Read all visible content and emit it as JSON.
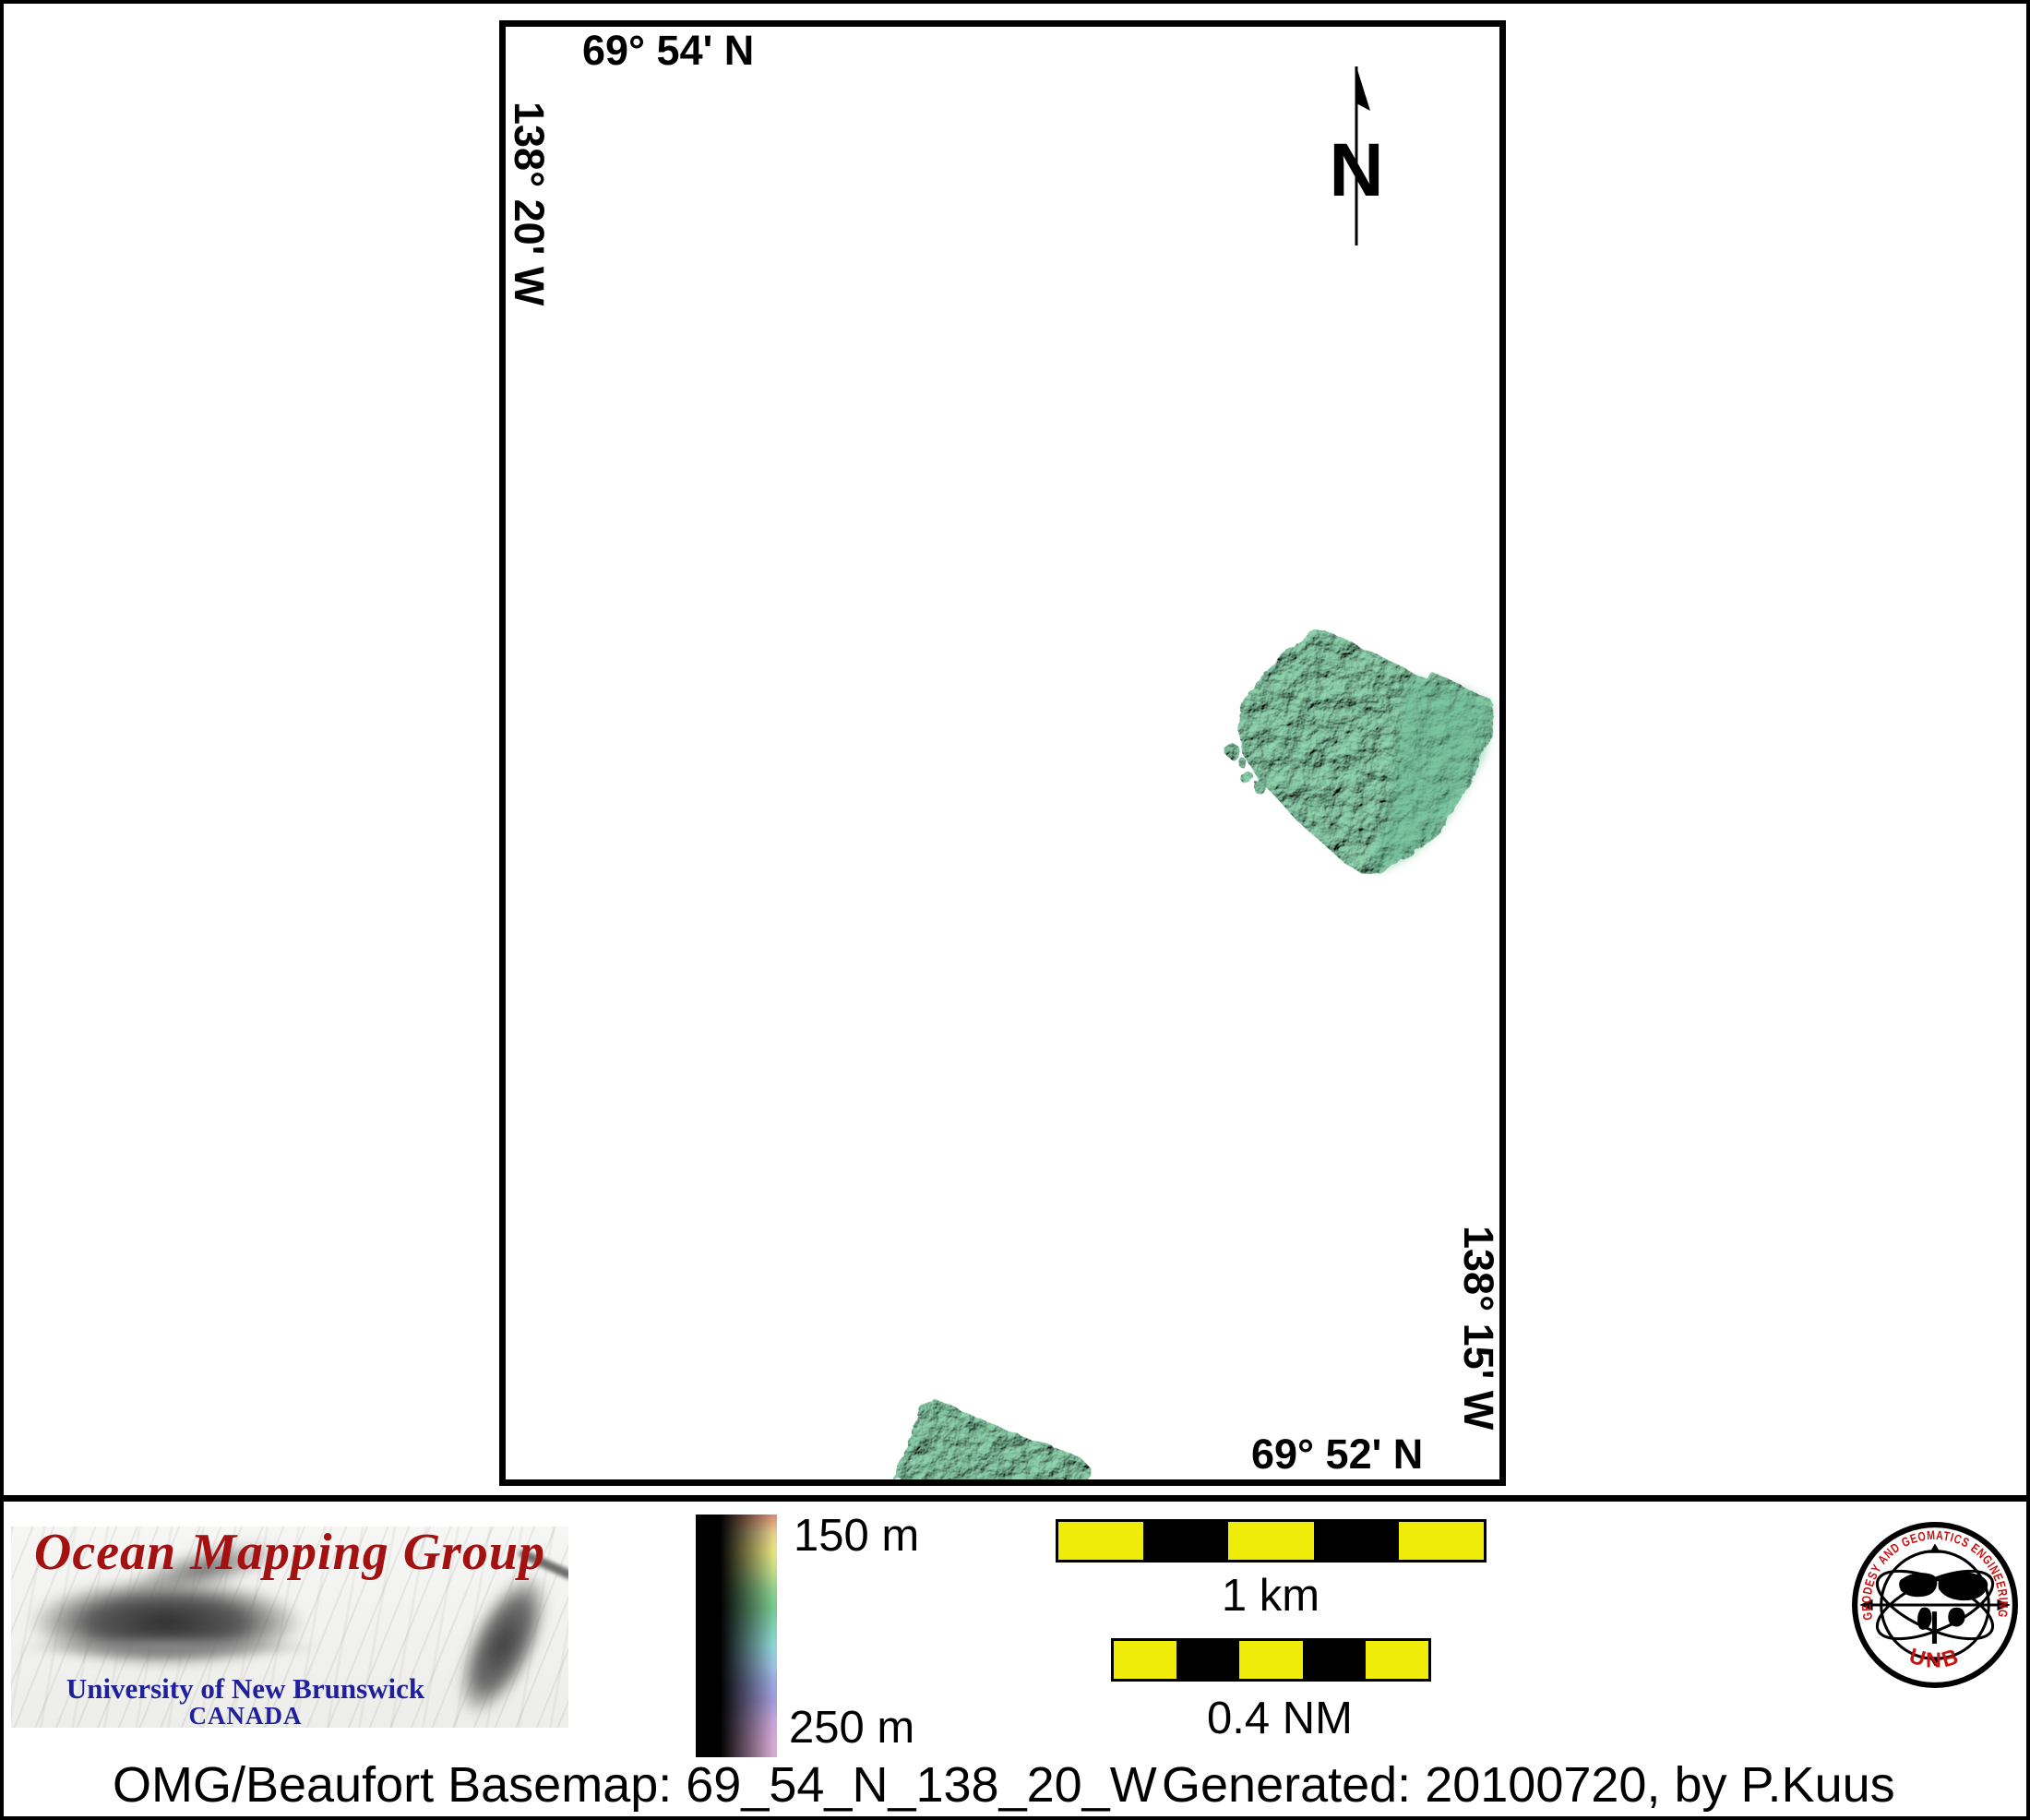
{
  "map": {
    "top_lat_label": "69° 54' N",
    "left_lon_label": "138° 20' W",
    "right_lon_label": "138° 15' W",
    "bottom_lat_label": "69° 52' N",
    "north_arrow_letter": "N"
  },
  "footer": {
    "omg_banner": {
      "title": "Ocean Mapping Group",
      "university": "University of New Brunswick",
      "country": "CANADA"
    },
    "colorbar": {
      "top_label": "150 m",
      "bottom_label": "250 m",
      "stops": [
        "#d98b75",
        "#e3cf8d",
        "#e8e37e",
        "#c3dc87",
        "#8ecf8e",
        "#77c78f",
        "#82cdb4",
        "#8fd4d4",
        "#9cc3e3",
        "#9aa6dd",
        "#a49ad8",
        "#c3a3d8",
        "#d4a8d4",
        "#d8abce"
      ]
    },
    "scalebar_km": {
      "label": "1 km",
      "segments": [
        "yellow",
        "black",
        "yellow",
        "black",
        "yellow"
      ]
    },
    "scalebar_nm": {
      "label": "0.4 NM",
      "segments": [
        "yellow",
        "black",
        "yellow",
        "black",
        "yellow"
      ]
    },
    "unb_logo": {
      "ring_text": "GEODESY AND GEOMATICS ENGINEERING",
      "bottom_text": "UNB"
    },
    "caption_left": "OMG/Beaufort Basemap: 69_54_N_138_20_W",
    "caption_right": "Generated: 20100720, by P.Kuus"
  },
  "colors": {
    "omg-red": "#a31111",
    "unb-blue": "#20209c",
    "logo-red": "#cc1111",
    "scale-yellow": "#f0ec0a",
    "swath-green": "#57a98c",
    "swath-green-light": "#8fd4ae",
    "swath-green-dark": "#1c4635"
  }
}
